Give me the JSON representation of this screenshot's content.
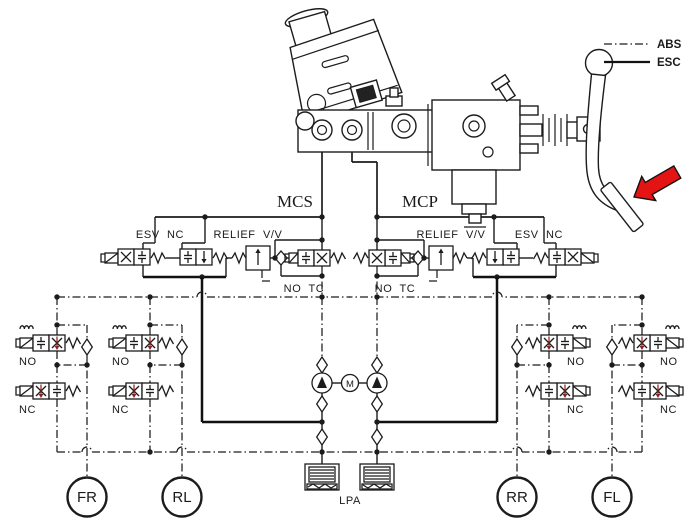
{
  "diagram": {
    "legend": {
      "abs": "ABS",
      "esc": "ESC"
    },
    "labels": {
      "mcs": "MCS",
      "mcp": "MCP",
      "esv_nc": "ESV  NC",
      "relief": "RELIEF  V/V",
      "no_tc": "NO  TC",
      "no": "NO",
      "nc": "NC",
      "lpa": "LPA",
      "motor": "M"
    },
    "wheels": [
      "FR",
      "RL",
      "RR",
      "FL"
    ],
    "colors": {
      "line": "#1c1c1c",
      "valve_arrow": "#8a2020",
      "pedal_arrow": "#e41414",
      "background": "#ffffff"
    }
  }
}
